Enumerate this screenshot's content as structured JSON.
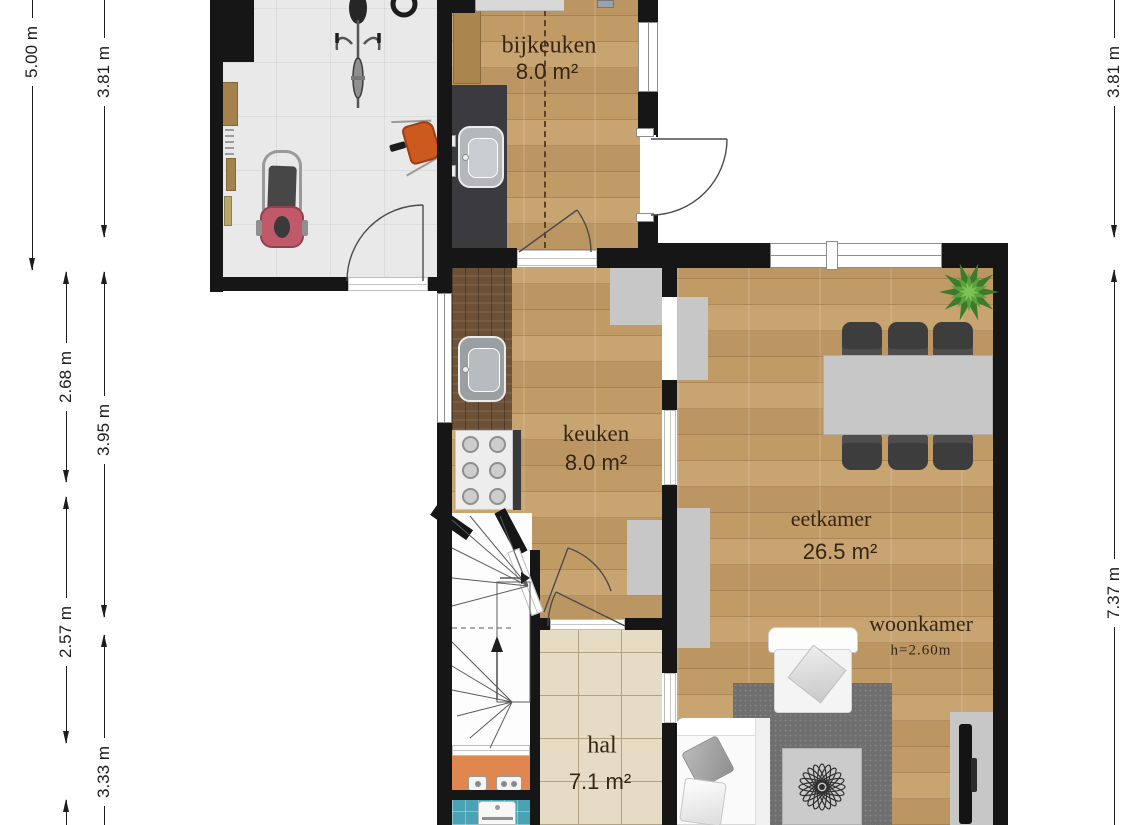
{
  "colors": {
    "wall": "#161616",
    "wood": "#c59e68",
    "wood-dark": "#6d5136",
    "garage-tile": "#e9e9ea",
    "hal-tile": "#e6dcc6",
    "hal-grout": "#b3a183",
    "toilet-floor": "#df874e",
    "bath-tile": "#4aa2b5",
    "counter-dark": "#3b3b3f",
    "cabinet-grey": "#c7c7c7",
    "chair-dark": "#3d3d3d",
    "rug-grey": "#6f6f6f",
    "plant-green": "#4c8a36",
    "mower-pink": "#c05a6b",
    "wheelbarrow-orange": "#cc5a1f",
    "label-ink": "#352614",
    "dim-ink": "#1d1d1d"
  },
  "rooms": {
    "bijkeuken": {
      "name": "bijkeuken",
      "area": "8.0 m²"
    },
    "keuken": {
      "name": "keuken",
      "area": "8.0 m²"
    },
    "eetkamer": {
      "name": "eetkamer",
      "area": "26.5 m²"
    },
    "woonkamer": {
      "name": "woonkamer",
      "ceiling_height": "h=2.60m"
    },
    "hal": {
      "name": "hal",
      "area": "7.1 m²"
    }
  },
  "dimensions": {
    "left_outer": {
      "label": "5.00 m"
    },
    "left_inner_top": {
      "label": "3.81 m"
    },
    "left_mid_a": {
      "label": "2.68 m"
    },
    "left_mid_b": {
      "label": "3.95 m"
    },
    "left_low_a": {
      "label": "2.57 m"
    },
    "left_low_b": {
      "label": "3.33 m"
    },
    "right_top": {
      "label": "3.81 m"
    },
    "right_main": {
      "label": "7.37 m"
    }
  },
  "objects": [
    "workbench",
    "shelf-planks",
    "bicycle",
    "garden-hose",
    "lawnmower",
    "wheelbarrow",
    "utility-sink",
    "kitchen-sink",
    "gas-stove",
    "dining-table",
    "dining-chairs",
    "potted-plant",
    "wall-cabinet",
    "armchair",
    "sofa",
    "rug",
    "coffee-table",
    "tv",
    "tv-stand",
    "staircase",
    "washing-machine",
    "toilet-fixtures"
  ]
}
